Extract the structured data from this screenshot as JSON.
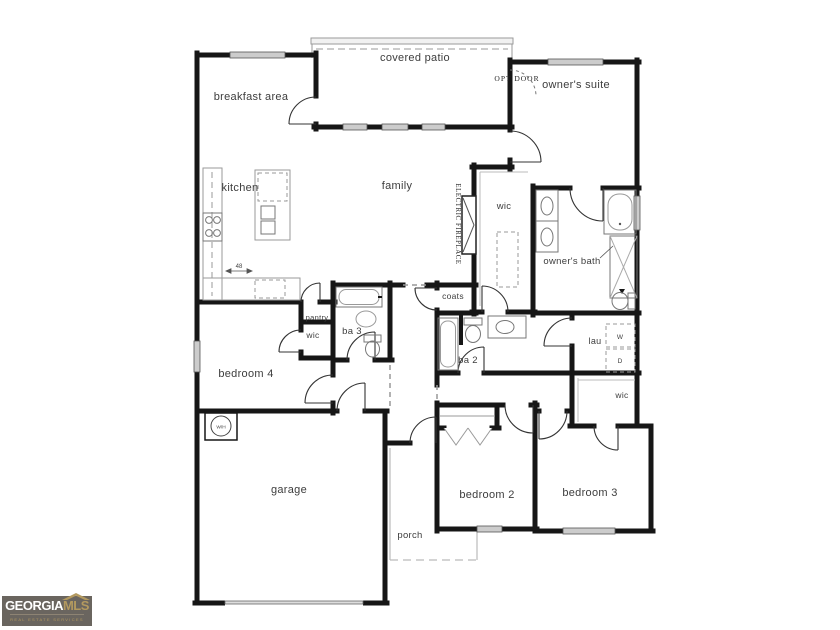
{
  "floorplan": {
    "rooms": {
      "breakfast_area": "breakfast area",
      "covered_patio": "covered patio",
      "owners_suite": "owner's suite",
      "kitchen": "kitchen",
      "family": "family",
      "owners_wic": "wic",
      "owners_bath": "owner's bath",
      "coats": "coats",
      "pantry": "pantry",
      "bedroom4_wic": "wic",
      "ba3": "ba 3",
      "bedroom4": "bedroom 4",
      "ba2": "ba 2",
      "laundry": "lau",
      "bedroom3_wic": "wic",
      "bedroom2": "bedroom 2",
      "bedroom3": "bedroom 3",
      "garage": "garage",
      "porch": "porch"
    },
    "annotations": {
      "opt_door": "OPT DOOR",
      "electric_fireplace": "ELECTRIC FIREPLACE",
      "washer": "W",
      "dryer": "D",
      "water_heater": "W/H",
      "island_width": "48"
    },
    "colors": {
      "wall": "#161616",
      "window_fill": "#cccccc",
      "fixture_line": "#8a8a8a",
      "background": "#ffffff"
    }
  },
  "logo": {
    "brand_primary": "GEORGIA",
    "brand_secondary": "MLS",
    "tagline": "REAL ESTATE SERVICES",
    "colors": {
      "background": "#6a655f",
      "primary_text": "#ffffff",
      "accent": "#b3995f"
    }
  }
}
